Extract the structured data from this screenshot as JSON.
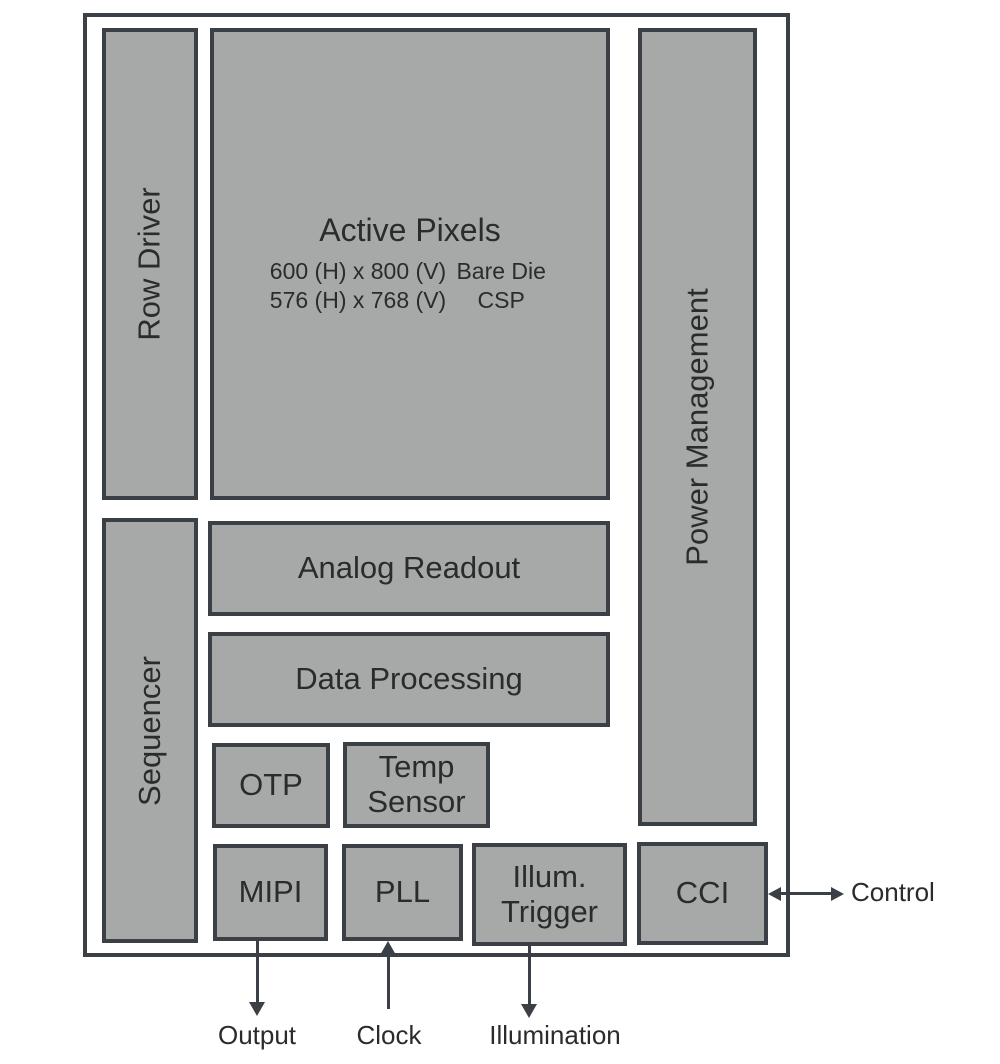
{
  "diagram": {
    "blocks": {
      "row_driver": {
        "label": "Row Driver"
      },
      "active_pixels": {
        "title": "Active Pixels",
        "rows": [
          {
            "dims": "600 (H) x 800 (V)",
            "pkg": "Bare Die"
          },
          {
            "dims": "576 (H) x 768 (V)",
            "pkg": "CSP"
          }
        ]
      },
      "power_management": {
        "label": "Power Management"
      },
      "sequencer": {
        "label": "Sequencer"
      },
      "analog_readout": {
        "label": "Analog Readout"
      },
      "data_processing": {
        "label": "Data Processing"
      },
      "otp": {
        "label": "OTP"
      },
      "temp_sensor": {
        "lines": [
          "Temp",
          "Sensor"
        ]
      },
      "mipi": {
        "label": "MIPI"
      },
      "pll": {
        "label": "PLL"
      },
      "illum_trigger": {
        "lines": [
          "Illum.",
          "Trigger"
        ]
      },
      "cci": {
        "label": "CCI"
      }
    },
    "signals": {
      "control": {
        "label": "Control",
        "direction": "bidirectional"
      },
      "output": {
        "label": "Output",
        "direction": "down"
      },
      "clock": {
        "label": "Clock",
        "direction": "up"
      },
      "illumination": {
        "label": "Illumination",
        "direction": "down"
      }
    },
    "colors": {
      "background": "#ffffff",
      "block_fill": "#a7a9a9",
      "block_border": "#3b3f46",
      "outer_border": "#3b3f46",
      "arrow": "#3b4046",
      "text": "#2b2b2b"
    }
  }
}
